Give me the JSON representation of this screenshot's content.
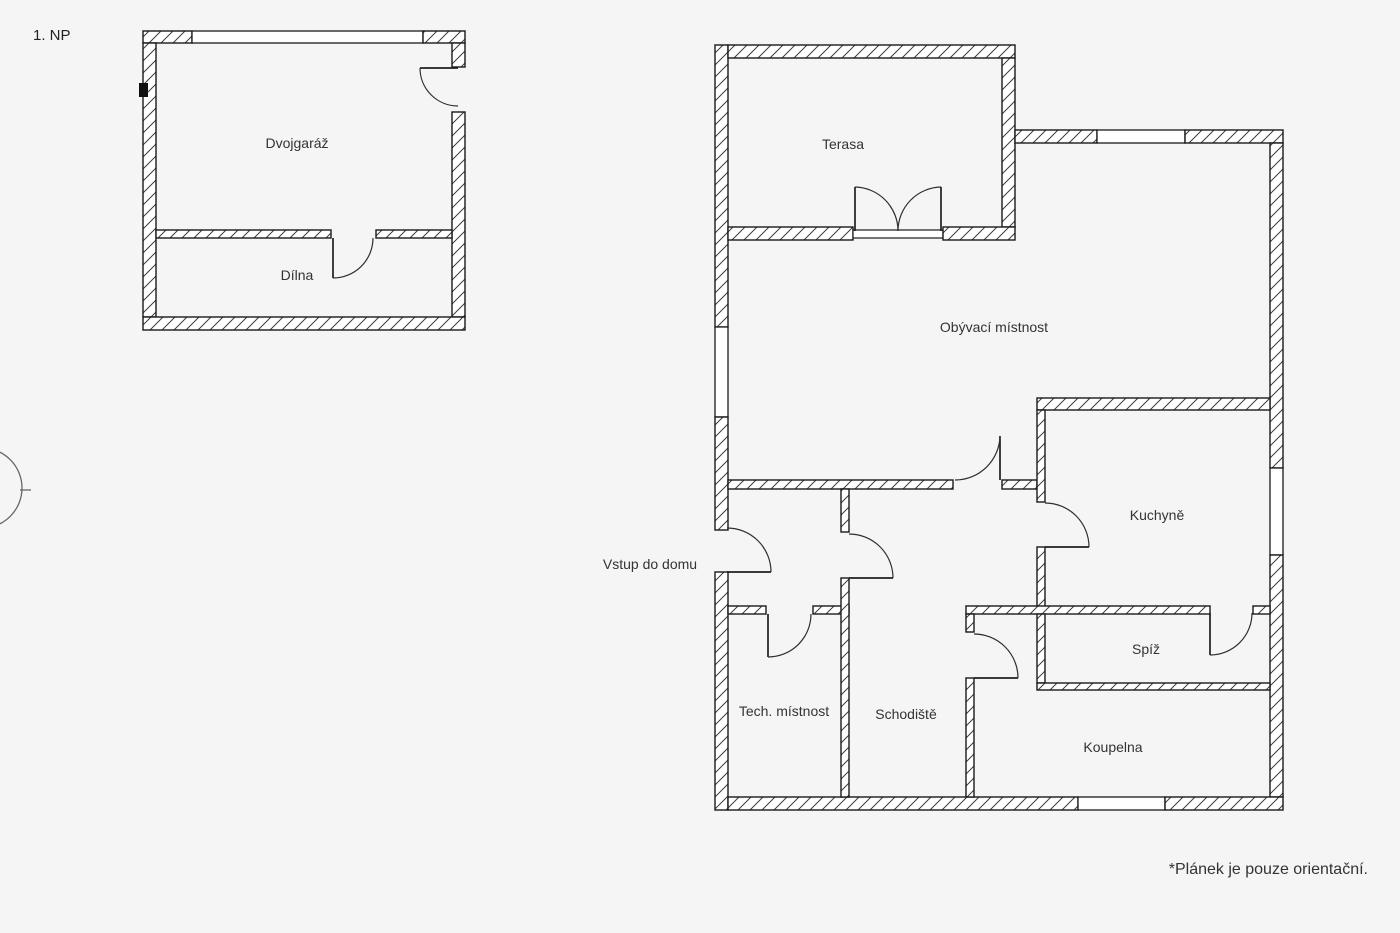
{
  "plan": {
    "floor_label": "1. NP",
    "footnote": "*Plánek je pouze orientační.",
    "entrance_label": "Vstup do domu",
    "rooms": {
      "dvojgaraz": "Dvojgaráž",
      "dilna": "Dílna",
      "terasa": "Terasa",
      "obyvaci_mistnost": "Obývací místnost",
      "kuchyne": "Kuchyně",
      "spiz": "Spíž",
      "koupelna": "Koupelna",
      "schodiste": "Schodiště",
      "tech_mistnost": "Tech. místnost"
    },
    "colors": {
      "background": "#f5f5f6",
      "wall_fill": "#ffffff",
      "wall_line": "#1a1a1a",
      "hatch_line": "#3d3d3d",
      "text": "#333333"
    }
  }
}
